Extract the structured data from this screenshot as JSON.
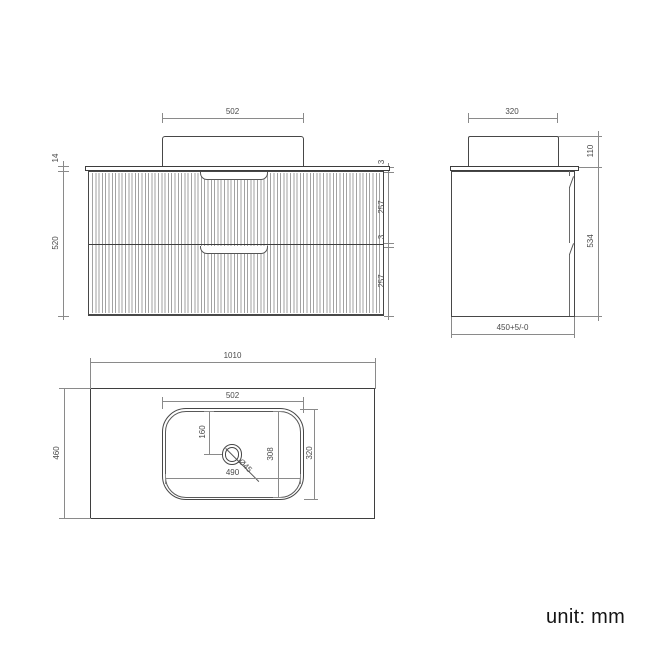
{
  "drawing": {
    "unit_label": "unit: mm",
    "front_view": {
      "basin_width": "502",
      "countertop_thickness": "14",
      "cabinet_height": "520",
      "top_gap": "3",
      "drawer1_height": "257",
      "middle_gap": "3",
      "drawer2_height": "257"
    },
    "side_view": {
      "basin_depth": "320",
      "basin_height": "110",
      "cabinet_height": "534",
      "cabinet_depth_tolerance": "450+5/-0"
    },
    "top_view": {
      "countertop_width": "1010",
      "countertop_depth": "460",
      "basin_outer_width": "502",
      "drain_offset": "160",
      "basin_inner_width": "490",
      "basin_inner_depth": "308",
      "basin_outer_depth": "320",
      "drain_diameter": "Ø45"
    }
  }
}
